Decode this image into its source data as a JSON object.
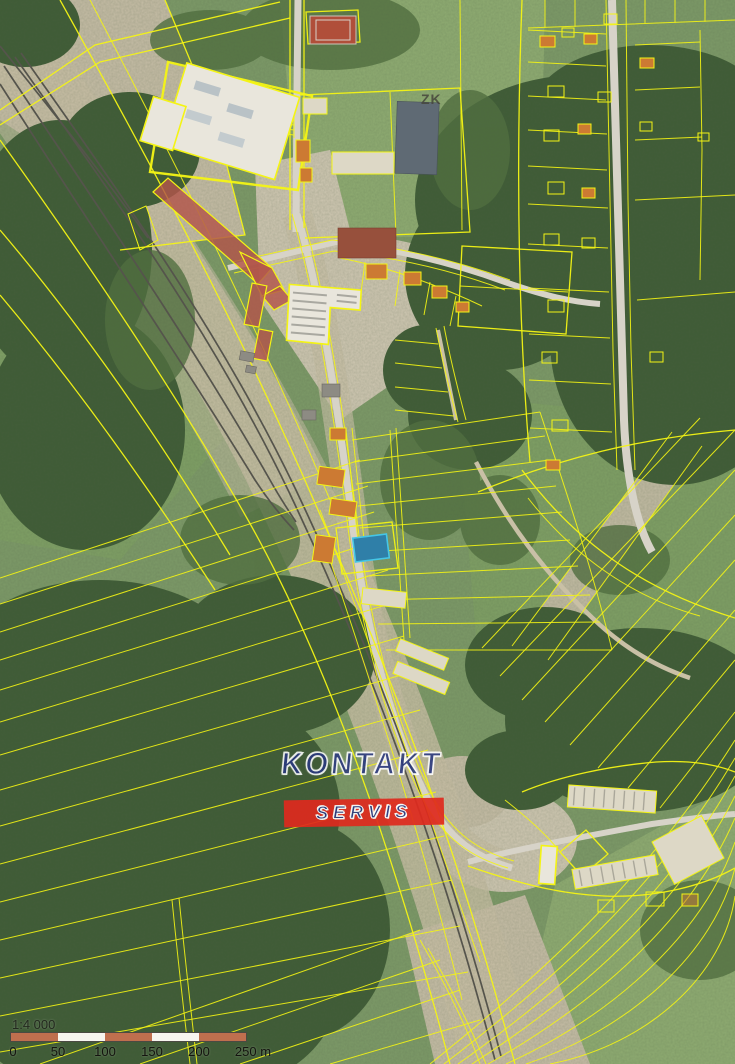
{
  "map": {
    "description": "aerial orthophoto with cadastral parcel overlay"
  },
  "watermark": {
    "line1": "KONTAKT",
    "line2": "SERVIS"
  },
  "attribution": {
    "text": "ZK"
  },
  "scalebar": {
    "ratio": "1:4 000",
    "tick_labels": [
      "0",
      "50",
      "100",
      "150",
      "200",
      "250 m"
    ]
  },
  "colors": {
    "parcel_line": "#f4f414",
    "building_fill": "#b2564a",
    "orange_roof": "#cc7a33",
    "pool_fill": "#2f7fa8",
    "pool_stroke": "#45c6e6",
    "watermark_blue": "#2a3880",
    "watermark_red": "#df2a1e",
    "scale_seg_a": "#bf6f4e",
    "scale_seg_b": "#f7f5ef"
  }
}
